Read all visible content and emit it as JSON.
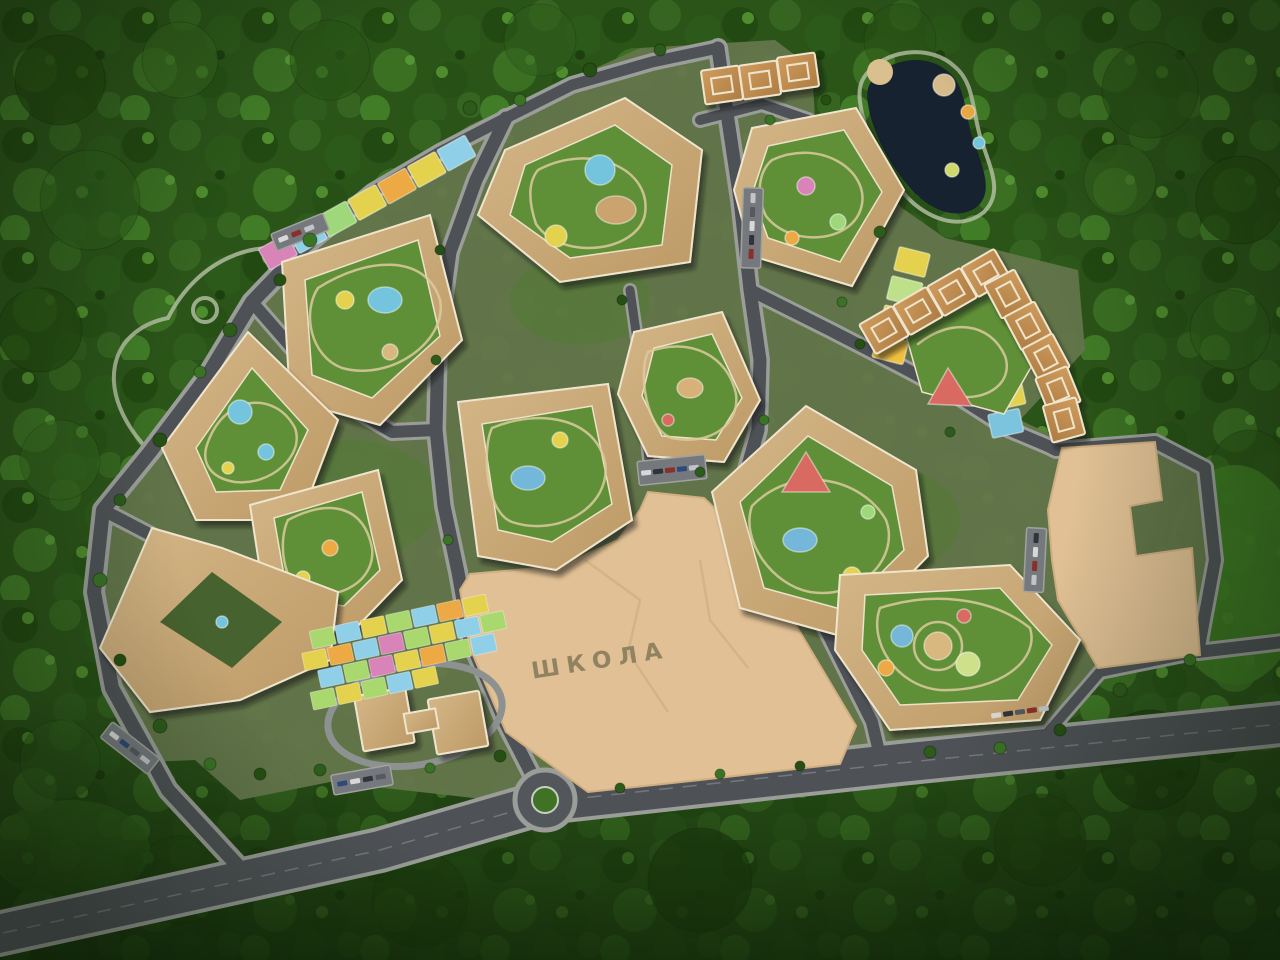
{
  "scene": {
    "labels": {
      "school": "ШКОЛА"
    },
    "palette": {
      "forest_dark": "#22480f",
      "forest_mid": "#2b5419",
      "forest_light": "#417c27",
      "lawn": "#5f9038",
      "road_asphalt": "#4e5256",
      "sidewalk": "#9a9d98",
      "roof": "#c9a878",
      "tower_roof": "#c1904f",
      "parapet": "#efe5cd",
      "lot": "#e0c094",
      "school_text": "#8d7f60",
      "pond": "#16222f",
      "beach": "#dbc08f",
      "play_blue": "#74c4de",
      "play_yellow": "#e4d24f",
      "play_orange": "#eda943",
      "play_green": "#9fd87a",
      "play_pink": "#d884b8",
      "play_red": "#d96a62"
    },
    "features": [
      "forest",
      "boulevard",
      "roundabout",
      "ring-road",
      "internal-streets",
      "courtyard-apartment-blocks",
      "tower-blocks",
      "school-site",
      "reserve-site",
      "kindergarten",
      "play-plots",
      "sports-courts",
      "pond",
      "beach",
      "pond-park",
      "parking-lots",
      "walking-trails",
      "playgrounds"
    ]
  }
}
